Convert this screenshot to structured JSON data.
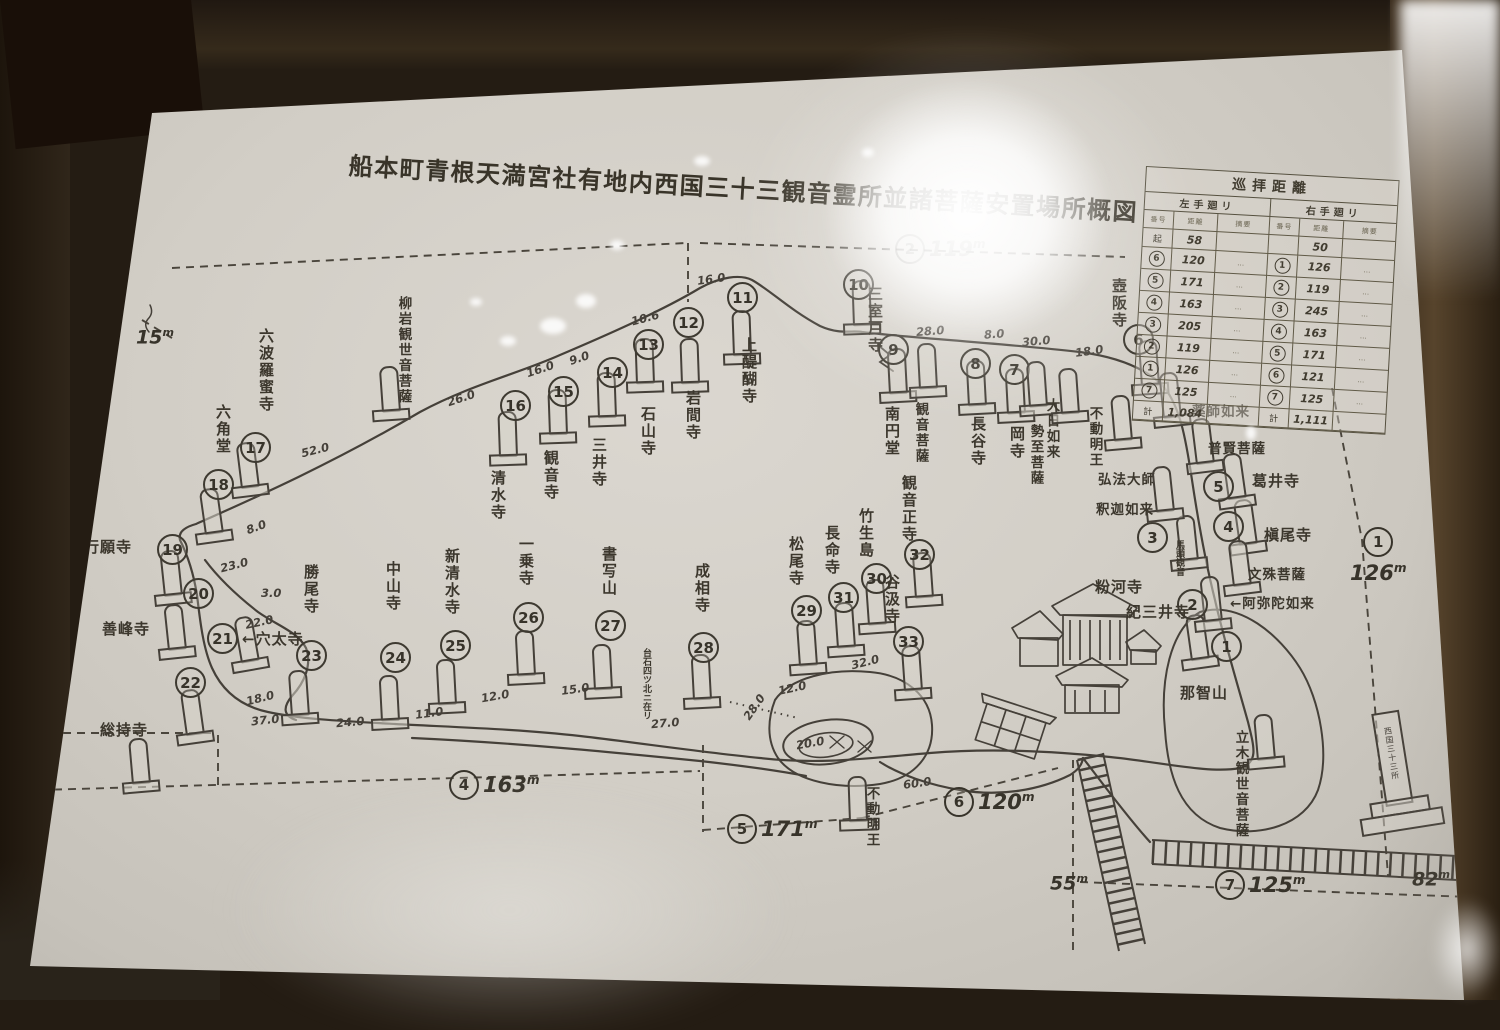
{
  "title": "船本町青根天満宮社有地内西国三十三観音霊所並諸菩薩安置場所概図",
  "stations": [
    {
      "n": "1",
      "name": "那智山",
      "c": [
        1226,
        646
      ],
      "s": [
        1200,
        666,
        -8
      ],
      "l": [
        1180,
        682
      ],
      "lv": false
    },
    {
      "n": "2",
      "name": "紀三井寺",
      "c": [
        1192,
        604
      ],
      "s": [
        1213,
        628,
        -6
      ],
      "l": [
        1126,
        601
      ],
      "lv": false
    },
    {
      "n": "3",
      "name": "粉河寺",
      "c": [
        1152,
        537
      ],
      "s": [
        1189,
        567,
        -6
      ],
      "l": [
        1095,
        576
      ],
      "lv": false,
      "note": "馬頭観音",
      "nl": [
        1174,
        540
      ]
    },
    {
      "n": "4",
      "name": "槇尾寺",
      "c": [
        1228,
        526
      ],
      "s": [
        1248,
        551,
        -8
      ],
      "l": [
        1264,
        524
      ],
      "lv": false
    },
    {
      "n": "5",
      "name": "葛井寺",
      "c": [
        1218,
        486
      ],
      "s": [
        1237,
        505,
        -8
      ],
      "l": [
        1252,
        470
      ],
      "lv": false
    },
    {
      "n": "6",
      "name": "壺阪寺",
      "c": [
        1138,
        339
      ],
      "s": [
        1150,
        392,
        -4
      ],
      "l": [
        1120,
        278
      ],
      "lv": true
    },
    {
      "n": "7",
      "name": "岡寺",
      "c": [
        1014,
        369
      ],
      "s": [
        1016,
        420,
        -3
      ],
      "l": [
        1018,
        426
      ],
      "lv": true
    },
    {
      "n": "8",
      "name": "長谷寺",
      "c": [
        975,
        363
      ],
      "s": [
        977,
        412,
        -3
      ],
      "l": [
        979,
        416
      ],
      "lv": true
    },
    {
      "n": "9",
      "name": "南円堂",
      "c": [
        893,
        349
      ],
      "s": [
        898,
        400,
        -3
      ],
      "l": [
        893,
        406
      ],
      "lv": true
    },
    {
      "n": "10",
      "name": "三室戸寺",
      "c": [
        858,
        284
      ],
      "s": [
        862,
        332,
        -2
      ],
      "l": [
        876,
        286
      ],
      "lv": true
    },
    {
      "n": "11",
      "name": "上醍醐寺",
      "c": [
        742,
        297
      ],
      "s": [
        742,
        362,
        -2
      ],
      "l": [
        750,
        337
      ],
      "lv": true
    },
    {
      "n": "12",
      "name": "岩間寺",
      "c": [
        688,
        322
      ],
      "s": [
        690,
        390,
        -2
      ],
      "l": [
        694,
        390
      ],
      "lv": true
    },
    {
      "n": "13",
      "name": "石山寺",
      "c": [
        648,
        344
      ],
      "s": [
        645,
        390,
        -2
      ],
      "l": [
        649,
        406
      ],
      "lv": true
    },
    {
      "n": "14",
      "name": "三井寺",
      "c": [
        612,
        372
      ],
      "s": [
        607,
        424,
        -2
      ],
      "l": [
        600,
        437
      ],
      "lv": true
    },
    {
      "n": "15",
      "name": "観音寺",
      "c": [
        563,
        391
      ],
      "s": [
        558,
        441,
        -2
      ],
      "l": [
        552,
        450
      ],
      "lv": true
    },
    {
      "n": "16",
      "name": "清水寺",
      "c": [
        515,
        405
      ],
      "s": [
        508,
        463,
        -2
      ],
      "l": [
        499,
        470
      ],
      "lv": true
    },
    {
      "n": "17",
      "name": "六波羅蜜寺",
      "c": [
        255,
        447
      ],
      "s": [
        250,
        494,
        -7
      ],
      "l": [
        267,
        328
      ],
      "lv": true
    },
    {
      "n": "18",
      "name": "六角堂",
      "c": [
        218,
        484
      ],
      "s": [
        214,
        540,
        -8
      ],
      "l": [
        224,
        404
      ],
      "lv": true
    },
    {
      "n": "19",
      "name": "行願寺",
      "c": [
        172,
        549
      ],
      "s": [
        173,
        602,
        -6
      ],
      "l": [
        84,
        536
      ],
      "lv": false
    },
    {
      "n": "20",
      "name": "善峰寺",
      "c": [
        198,
        593
      ],
      "s": [
        177,
        656,
        -6
      ],
      "l": [
        102,
        618
      ],
      "lv": false
    },
    {
      "n": "21",
      "name": "←穴太寺",
      "c": [
        222,
        638
      ],
      "s": [
        250,
        668,
        -10
      ],
      "l": [
        242,
        628
      ],
      "lv": false
    },
    {
      "n": "22",
      "name": "総持寺",
      "c": [
        190,
        682
      ],
      "s": [
        195,
        741,
        -8
      ],
      "l": [
        100,
        719
      ],
      "lv": false
    },
    {
      "n": "23",
      "name": "勝尾寺",
      "c": [
        311,
        655
      ],
      "s": [
        300,
        722,
        -4
      ],
      "l": [
        312,
        564
      ],
      "lv": true
    },
    {
      "n": "24",
      "name": "中山寺",
      "c": [
        395,
        657
      ],
      "s": [
        390,
        727,
        -3
      ],
      "l": [
        394,
        561
      ],
      "lv": true
    },
    {
      "n": "25",
      "name": "新清水寺",
      "c": [
        455,
        645
      ],
      "s": [
        447,
        711,
        -3
      ],
      "l": [
        453,
        548
      ],
      "lv": true
    },
    {
      "n": "26",
      "name": "一乗寺",
      "c": [
        528,
        617
      ],
      "s": [
        526,
        682,
        -3
      ],
      "l": [
        527,
        536
      ],
      "lv": true
    },
    {
      "n": "27",
      "name": "書写山",
      "c": [
        610,
        625
      ],
      "s": [
        603,
        696,
        -3
      ],
      "l": [
        610,
        546
      ],
      "lv": true,
      "note": "台石四ツ北ニ在リ",
      "nl": [
        641,
        648
      ]
    },
    {
      "n": "28",
      "name": "成相寺",
      "c": [
        703,
        647
      ],
      "s": [
        702,
        706,
        -3
      ],
      "l": [
        703,
        563
      ],
      "lv": true
    },
    {
      "n": "29",
      "name": "松尾寺",
      "c": [
        806,
        610
      ],
      "s": [
        808,
        672,
        -4
      ],
      "l": [
        797,
        536
      ],
      "lv": true
    },
    {
      "n": "30",
      "name": "竹生島",
      "c": [
        876,
        578
      ],
      "s": [
        877,
        631,
        -4
      ],
      "l": [
        867,
        508
      ],
      "lv": true
    },
    {
      "n": "31",
      "name": "長命寺",
      "c": [
        843,
        597
      ],
      "s": [
        846,
        654,
        -4
      ],
      "l": [
        833,
        525
      ],
      "lv": true
    },
    {
      "n": "32",
      "name": "観音正寺",
      "c": [
        919,
        554
      ],
      "s": [
        924,
        604,
        -4
      ],
      "l": [
        910,
        475
      ],
      "lv": true
    },
    {
      "n": "33",
      "name": "谷汲寺",
      "c": [
        908,
        641
      ],
      "s": [
        913,
        697,
        -4
      ],
      "l": [
        893,
        574
      ],
      "lv": true
    }
  ],
  "figures": [
    {
      "name": "柳岩観世音菩薩",
      "s": [
        391,
        418,
        -4
      ],
      "l": [
        405,
        296
      ],
      "lv": true
    },
    {
      "name": "観音菩薩",
      "s": [
        928,
        395,
        -3
      ],
      "l": [
        922,
        402
      ],
      "lv": true
    },
    {
      "name": "大日如来",
      "s": [
        1038,
        413,
        -4
      ],
      "l": [
        1053,
        398
      ],
      "lv": true
    },
    {
      "name": "勢至菩薩",
      "s": [
        1070,
        420,
        -4
      ],
      "l": [
        1037,
        424
      ],
      "lv": true
    },
    {
      "name": "不動明王",
      "s": [
        1123,
        447,
        -5
      ],
      "l": [
        1096,
        406
      ],
      "lv": true
    },
    {
      "name": "弘法大師",
      "l": [
        1098,
        468
      ],
      "lv": false
    },
    {
      "name": "釈迦如来",
      "s": [
        1165,
        518,
        -6
      ],
      "l": [
        1096,
        498
      ],
      "lv": false
    },
    {
      "name": "薬師如来",
      "s": [
        1172,
        424,
        -6
      ],
      "l": [
        1192,
        400
      ],
      "lv": false
    },
    {
      "name": "普賢菩薩",
      "s": [
        1205,
        470,
        -7
      ],
      "l": [
        1208,
        437
      ],
      "lv": false
    },
    {
      "name": "文殊菩薩",
      "s": [
        1242,
        592,
        -7
      ],
      "l": [
        1248,
        563
      ],
      "lv": false
    },
    {
      "name": "←阿弥陀如来",
      "l": [
        1230,
        592
      ],
      "lv": false
    },
    {
      "name": "立木観世音菩薩",
      "s": [
        1266,
        766,
        -5
      ],
      "l": [
        1242,
        730
      ],
      "lv": true
    },
    {
      "name": "不動明王",
      "s": [
        858,
        828,
        -2
      ],
      "l": [
        873,
        786
      ],
      "lv": true
    }
  ],
  "extra_stones": [
    [
      141,
      790,
      -5
    ]
  ],
  "distances": [
    [
      "26.0",
      447,
      391,
      -18
    ],
    [
      "16.0",
      526,
      362,
      -18
    ],
    [
      "9.0",
      569,
      351,
      -18
    ],
    [
      "10.6",
      631,
      311,
      -15
    ],
    [
      "16.0",
      697,
      272,
      -8
    ],
    [
      "28.0",
      916,
      324,
      -4
    ],
    [
      "8.0",
      984,
      327,
      -4
    ],
    [
      "30.0",
      1022,
      334,
      -5
    ],
    [
      "18.0",
      1075,
      344,
      -8
    ],
    [
      "52.0",
      301,
      443,
      -14
    ],
    [
      "8.0",
      246,
      520,
      -20
    ],
    [
      "23.0",
      220,
      558,
      -14
    ],
    [
      "3.0",
      261,
      586,
      0
    ],
    [
      "22.0",
      245,
      615,
      -12
    ],
    [
      "18.0",
      246,
      691,
      -14
    ],
    [
      "37.0",
      251,
      713,
      -6
    ],
    [
      "24.0",
      336,
      715,
      -5
    ],
    [
      "11.0",
      415,
      706,
      -8
    ],
    [
      "12.0",
      481,
      689,
      -10
    ],
    [
      "15.0",
      561,
      682,
      -8
    ],
    [
      "27.0",
      651,
      716,
      -5
    ],
    [
      "28.0",
      740,
      700,
      -55
    ],
    [
      "20.0",
      796,
      736,
      -10
    ],
    [
      "32.0",
      851,
      655,
      -14
    ],
    [
      "12.0",
      778,
      681,
      -12
    ],
    [
      "60.0",
      903,
      776,
      -8
    ]
  ],
  "markers": [
    {
      "n": "4",
      "v": "163",
      "x": 449,
      "y": 770
    },
    {
      "n": "5",
      "v": "171",
      "x": 727,
      "y": 814
    },
    {
      "n": "6",
      "v": "120",
      "x": 944,
      "y": 787
    },
    {
      "n": "7",
      "v": "125",
      "x": 1215,
      "y": 870
    },
    {
      "n": "2",
      "v": "119",
      "x": 895,
      "y": 234,
      "faded": true
    },
    {
      "n": "1",
      "v": "126",
      "x": 1350,
      "y": 527,
      "below": true
    }
  ],
  "plain_markers": [
    {
      "v": "82",
      "x": 1412,
      "y": 868
    },
    {
      "v": "55",
      "x": 1050,
      "y": 872
    },
    {
      "v": "15",
      "x": 136,
      "y": 326
    }
  ],
  "monument_text": "西国三十三所",
  "table": {
    "title": "巡拝距離",
    "group_left": "左手廻リ",
    "group_right": "右手廻リ",
    "cols": [
      "番号",
      "距離",
      "摘要"
    ],
    "pre_row": {
      "l": [
        "起",
        "58",
        ""
      ],
      "r": [
        "",
        "50",
        ""
      ]
    },
    "rows": [
      {
        "l": [
          "6",
          "120",
          "…"
        ],
        "r": [
          "1",
          "126",
          "…"
        ]
      },
      {
        "l": [
          "5",
          "171",
          "…"
        ],
        "r": [
          "2",
          "119",
          "…"
        ]
      },
      {
        "l": [
          "4",
          "163",
          "…"
        ],
        "r": [
          "3",
          "245",
          "…"
        ]
      },
      {
        "l": [
          "3",
          "205",
          "…"
        ],
        "r": [
          "4",
          "163",
          "…"
        ]
      },
      {
        "l": [
          "2",
          "119",
          "…"
        ],
        "r": [
          "5",
          "171",
          "…"
        ]
      },
      {
        "l": [
          "1",
          "126",
          "…"
        ],
        "r": [
          "6",
          "121",
          "…"
        ]
      },
      {
        "l": [
          "7",
          "125",
          "…"
        ],
        "r": [
          "7",
          "125",
          "…"
        ]
      }
    ],
    "totals": {
      "label": "計",
      "left": "1,084",
      "right": "1,111"
    }
  }
}
